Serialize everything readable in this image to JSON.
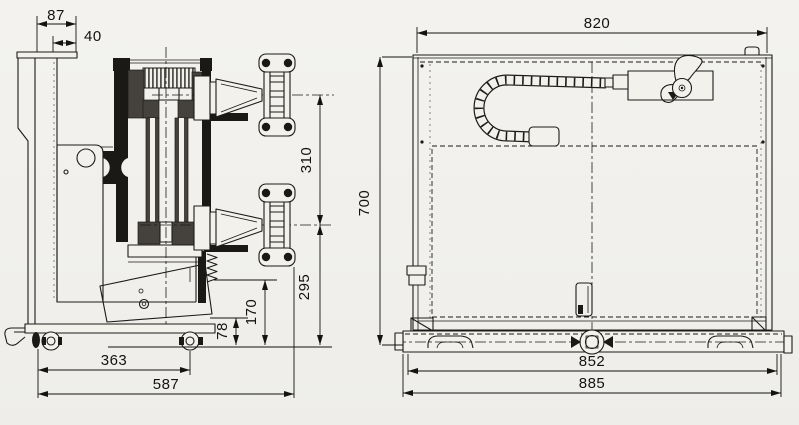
{
  "title": "Two-view dimensioned technical drawing of a wheeled machine unit",
  "colors": {
    "paper": "#f2f1ec",
    "ink": "#1c1b19",
    "dark_fill": "#45423d"
  },
  "side_view": {
    "name": "side-elevation",
    "dims": {
      "top_width": "87",
      "top_inner": "40",
      "arm_pitch": "310",
      "lower_arm_height": "295",
      "bracket_height": "170",
      "step_height": "78",
      "axle_span": "363",
      "overall_depth": "587"
    }
  },
  "front_view": {
    "name": "front-elevation",
    "dims": {
      "overall_width": "820",
      "overall_height": "700",
      "rail_span": "852",
      "overall_length": "885"
    }
  }
}
